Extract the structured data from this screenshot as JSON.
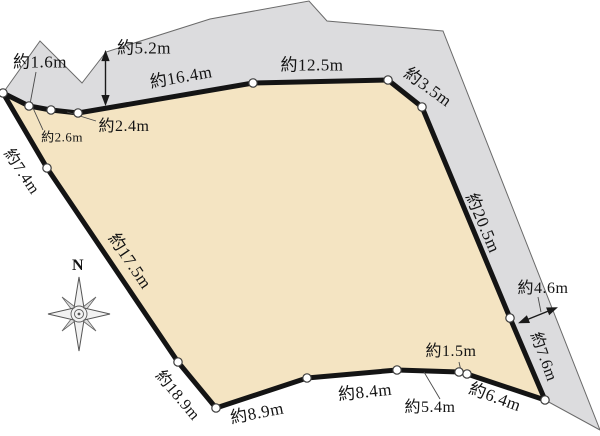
{
  "measurements": {
    "seg_1_6": "約1.6m",
    "offset_5_2": "約5.2m",
    "seg_16_4": "約16.4m",
    "seg_12_5": "約12.5m",
    "seg_3_5": "約3.5m",
    "seg_20_5": "約20.5m",
    "road_4_6": "約4.6m",
    "seg_7_6": "約7.6m",
    "seg_6_4": "約6.4m",
    "seg_1_5": "約1.5m",
    "seg_5_4": "約5.4m",
    "seg_8_4": "約8.4m",
    "seg_8_9": "約8.9m",
    "seg_18_9": "約18.9m",
    "seg_17_5": "約17.5m",
    "seg_7_4": "約7.4m",
    "seg_2_6": "約2.6m",
    "seg_2_4": "約2.4m"
  },
  "compass": {
    "north_label": "N"
  },
  "colors": {
    "parcel_fill": "#f4e4c2",
    "road_fill": "#dcdcde",
    "boundary": "#141414"
  }
}
